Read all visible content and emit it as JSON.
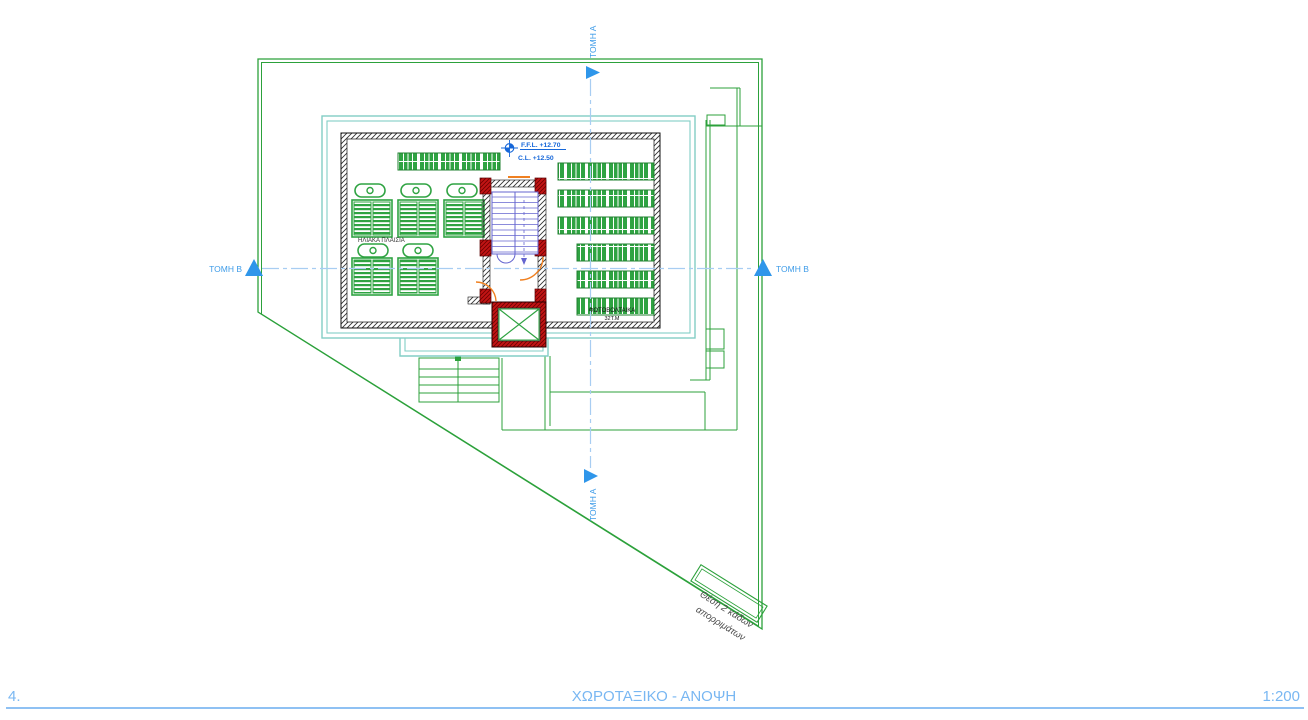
{
  "footer": {
    "number": "4.",
    "title": "ΧΩΡΟΤΑΞΙΚΟ - ΑΝΟΨΗ",
    "scale": "1:200"
  },
  "annotations": {
    "section_a": "ΤΟΜΗ Α",
    "section_b": "ΤΟΜΗ Β",
    "ffl": "F.F.L. +12.70",
    "cl": "C.L. +12.50",
    "solar_panels_label": "ΗΛΙΑΚΑ ΠΛΑΙΣΙΑ",
    "pv_label": "ΦΩΤΟΒΟΛΤΑΙΚΑ",
    "pv_area": "32Τ.Μ",
    "bins_label_line1": "Θέση 2 κάδων",
    "bins_label_line2": "απορριμάτων"
  },
  "colors": {
    "site_green": "#2ca13b",
    "panel_green": "#2fa342",
    "roof_teal": "#82cec5",
    "section_blue": "#3f9ce8",
    "marker_blue": "#2f96ea",
    "level_blue": "#1667d9",
    "wall_red": "#c21414",
    "stair_blue": "#6565cf",
    "door_orange": "#f08020",
    "footer_blue": "#79b7f2"
  }
}
